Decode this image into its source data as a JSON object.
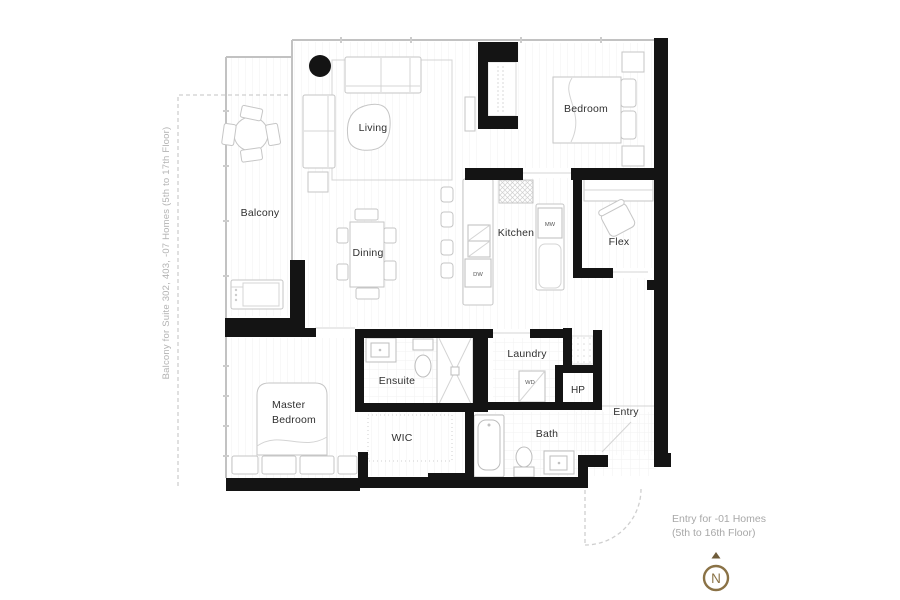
{
  "rooms": {
    "living": "Living",
    "bedroom": "Bedroom",
    "balcony": "Balcony",
    "dining": "Dining",
    "kitchen": "Kitchen",
    "flex": "Flex",
    "ensuite": "Ensuite",
    "laundry": "Laundry",
    "hp": "HP",
    "entry": "Entry",
    "master_line1": "Master",
    "master_line2": "Bedroom",
    "wic": "WIC",
    "bath": "Bath"
  },
  "appliances": {
    "mw": "MW",
    "dw": "DW",
    "wd": "WD"
  },
  "notes": {
    "side": "Balcony for Suite 302, 403, -07 Homes (5th to 17th Floor)",
    "entry_line1": "Entry for -01 Homes",
    "entry_line2": "(5th to 16th Floor)"
  },
  "compass": {
    "label": "N",
    "color": "#8a7246"
  },
  "colors": {
    "wall": "#141414",
    "window_line": "#c2c2c2",
    "fixture_stroke": "#c6c6c6",
    "floor_line": "#f1f1f1",
    "note_text": "#a8a8a8",
    "label_text": "#303030",
    "dashed_outline": "#cfcfcf",
    "background": "#ffffff"
  }
}
